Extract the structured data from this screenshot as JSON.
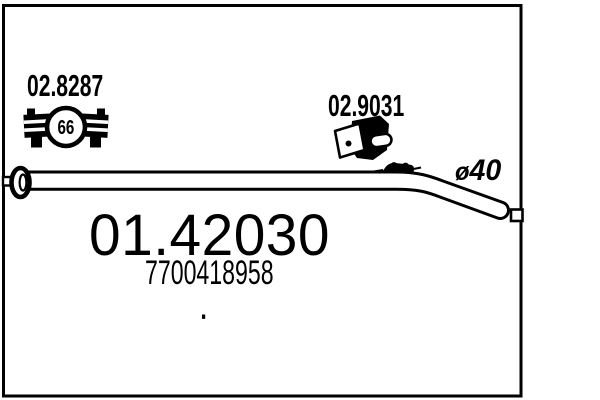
{
  "page": {
    "background_color": "#ffffff",
    "line_color": "#000000"
  },
  "diagram": {
    "main_part_number": "01.42030",
    "oem_reference_number": "7700418958",
    "pipe_diameter": {
      "symbol": "ø",
      "value": "40"
    },
    "components": [
      {
        "part_number": "02.8287",
        "type": "exhaust-clamp",
        "badge": "66"
      },
      {
        "part_number": "02.9031",
        "type": "rubber-hanger"
      }
    ]
  }
}
